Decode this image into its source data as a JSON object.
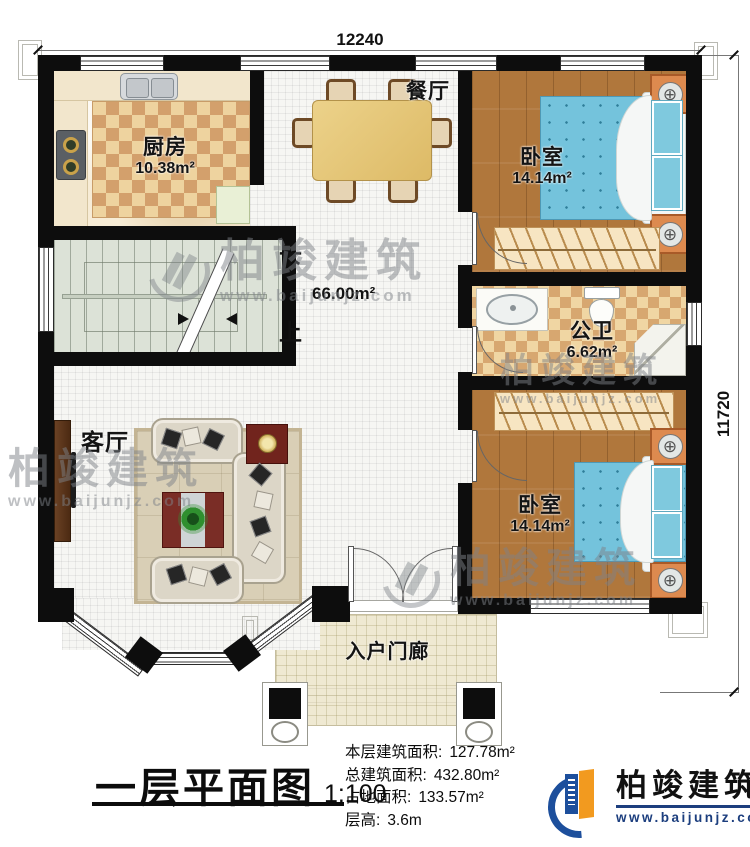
{
  "dimensions": {
    "top": "12240",
    "right": "11720"
  },
  "rooms": {
    "kitchen": {
      "name": "厨房",
      "area": "10.38m²"
    },
    "dining": {
      "name": "餐厅"
    },
    "bedroom_top": {
      "name": "卧室",
      "area": "14.14m²"
    },
    "bathroom": {
      "name": "公卫",
      "area": "6.62m²"
    },
    "bedroom_bottom": {
      "name": "卧室",
      "area": "14.14m²"
    },
    "living": {
      "name": "客厅"
    },
    "porch": {
      "name": "入户门廊"
    },
    "hall": {
      "area": "66.00m²",
      "stair_down": "下",
      "stair_up": "上"
    }
  },
  "title_block": {
    "title": "一层平面图",
    "scale": "1:100",
    "stats": [
      {
        "label": "本层建筑面积:",
        "value": "127.78m²"
      },
      {
        "label": "总建筑面积:",
        "value": "432.80m²"
      },
      {
        "label": "占地面积:",
        "value": "133.57m²"
      },
      {
        "label": "层高:",
        "value": "3.6m"
      }
    ]
  },
  "brand": {
    "name": "柏竣建筑",
    "url": "www.baijunjz.com"
  },
  "watermark": {
    "name": "柏竣建筑",
    "url": "www.baijunjz.com"
  }
}
